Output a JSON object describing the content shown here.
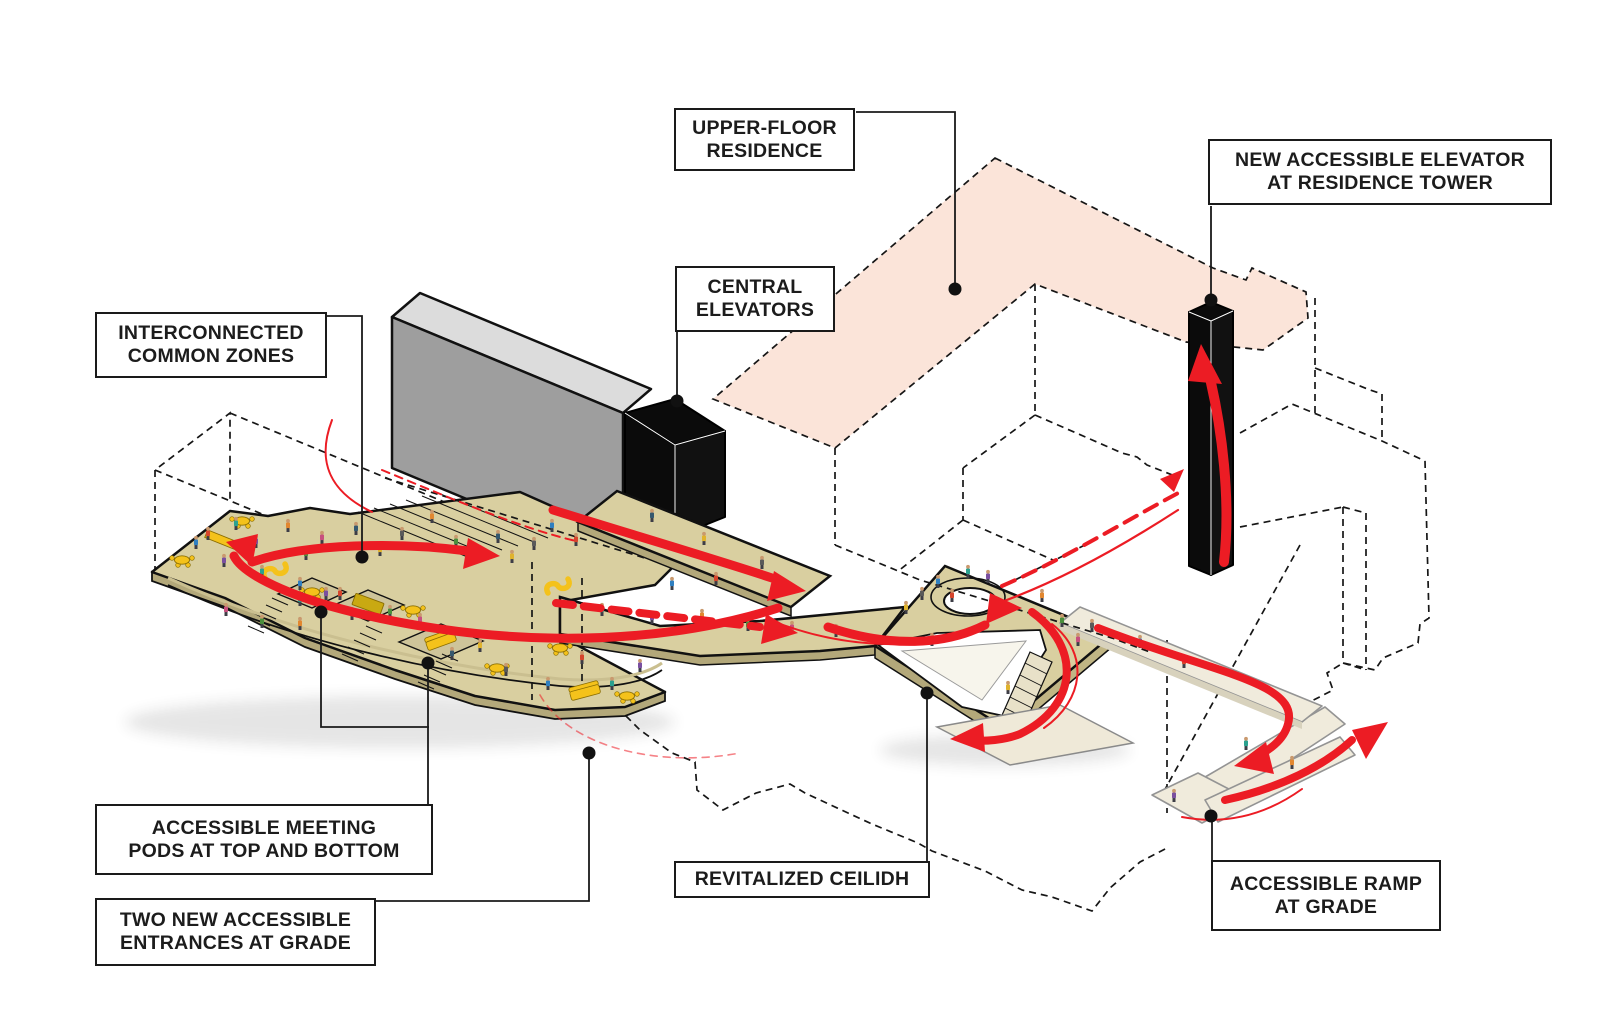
{
  "title": "Accessibility and circulation axonometric diagram",
  "labels": {
    "upper_floor_residence": {
      "line1": "UPPER-FLOOR",
      "line2": "RESIDENCE"
    },
    "central_elevators": {
      "line1": "CENTRAL",
      "line2": "ELEVATORS"
    },
    "new_accessible_elevator": {
      "line1": "NEW ACCESSIBLE ELEVATOR",
      "line2": "AT RESIDENCE TOWER"
    },
    "interconnected_common_zones": {
      "line1": "INTERCONNECTED",
      "line2": "COMMON ZONES"
    },
    "accessible_meeting_pods": {
      "line1": "ACCESSIBLE MEETING",
      "line2": "PODS AT TOP AND BOTTOM"
    },
    "two_new_entrances": {
      "line1": "TWO NEW ACCESSIBLE",
      "line2": "ENTRANCES AT GRADE"
    },
    "revitalized_ceilidh": {
      "line1": "REVITALIZED CEILIDH"
    },
    "accessible_ramp": {
      "line1": "ACCESSIBLE RAMP",
      "line2": "AT GRADE"
    }
  },
  "colors": {
    "accent_red": "#EC1C24",
    "plate_tan": "#D9CFA0",
    "plate_side": "#B3A87A",
    "ramp_cream": "#F0EBDC",
    "residence_pink": "#FBE4D9",
    "slab_gray": "#9E9E9E",
    "slab_top_gray": "#DCDCDC",
    "core_black": "#0B0B0B",
    "furniture_yellow": "#F4C21B",
    "outline": "#141414"
  },
  "palette": [
    "#2F7FC1",
    "#D6452C",
    "#2BA18F",
    "#7A4FA0",
    "#E2872F",
    "#4A8F3C",
    "#C84F7E",
    "#35586E",
    "#E0B32C",
    "#5A5A5A"
  ],
  "people": [
    [
      196,
      549
    ],
    [
      208,
      540
    ],
    [
      236,
      530
    ],
    [
      256,
      548
    ],
    [
      288,
      532
    ],
    [
      306,
      560
    ],
    [
      322,
      544
    ],
    [
      356,
      535
    ],
    [
      380,
      556
    ],
    [
      402,
      540
    ],
    [
      300,
      590
    ],
    [
      340,
      600
    ],
    [
      262,
      578
    ],
    [
      224,
      567
    ],
    [
      432,
      523
    ],
    [
      456,
      548
    ],
    [
      472,
      562
    ],
    [
      498,
      543
    ],
    [
      512,
      563
    ],
    [
      534,
      550
    ],
    [
      552,
      532
    ],
    [
      576,
      546
    ],
    [
      300,
      606
    ],
    [
      326,
      600
    ],
    [
      352,
      620
    ],
    [
      390,
      618
    ],
    [
      420,
      626
    ],
    [
      452,
      660
    ],
    [
      480,
      652
    ],
    [
      506,
      676
    ],
    [
      548,
      690
    ],
    [
      582,
      664
    ],
    [
      612,
      690
    ],
    [
      640,
      672
    ],
    [
      300,
      630
    ],
    [
      262,
      628
    ],
    [
      226,
      616
    ],
    [
      652,
      522
    ],
    [
      704,
      545
    ],
    [
      762,
      569
    ],
    [
      672,
      590
    ],
    [
      716,
      585
    ],
    [
      602,
      616
    ],
    [
      652,
      624
    ],
    [
      702,
      622
    ],
    [
      748,
      631
    ],
    [
      792,
      634
    ],
    [
      836,
      637
    ],
    [
      906,
      614
    ],
    [
      922,
      600
    ],
    [
      938,
      588
    ],
    [
      952,
      602
    ],
    [
      968,
      578
    ],
    [
      988,
      583
    ],
    [
      1042,
      602
    ],
    [
      1062,
      627
    ],
    [
      1078,
      646
    ],
    [
      932,
      646
    ],
    [
      1008,
      694
    ],
    [
      1092,
      632
    ],
    [
      1140,
      648
    ],
    [
      1184,
      668
    ],
    [
      1246,
      750
    ],
    [
      1174,
      802
    ],
    [
      1292,
      769
    ]
  ],
  "furniture": {
    "tables": [
      [
        182,
        560
      ],
      [
        242,
        521
      ],
      [
        312,
        592
      ],
      [
        413,
        610
      ],
      [
        497,
        668
      ],
      [
        627,
        696
      ],
      [
        560,
        648
      ]
    ],
    "big_tables": [
      [
        368,
        604
      ]
    ],
    "couches": [
      [
        441,
        641,
        -20
      ],
      [
        585,
        692,
        -15
      ]
    ],
    "desks": [
      [
        222,
        540
      ]
    ],
    "s_benches": [
      [
        275,
        571
      ],
      [
        558,
        586
      ]
    ]
  }
}
